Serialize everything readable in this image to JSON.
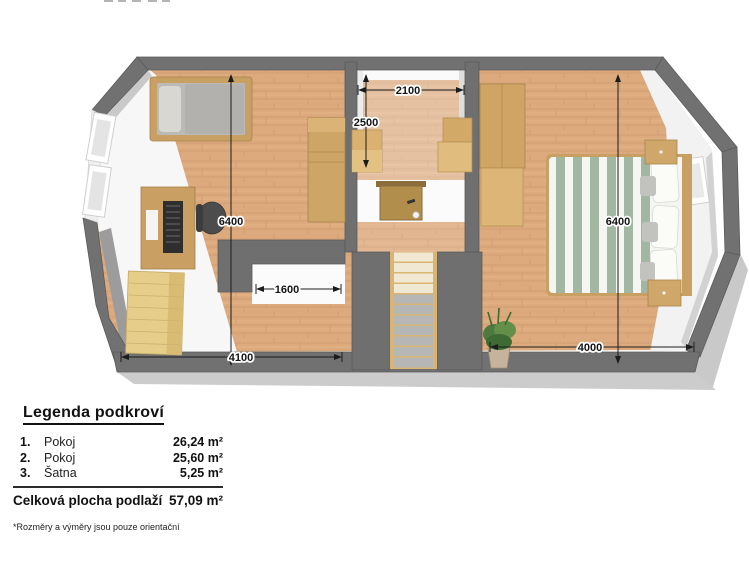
{
  "palette": {
    "wall_gray": "#717171",
    "wall_edge": "#5b5b5b",
    "wood_floor": "#dcaa7d",
    "wood_streak": "#c8956a",
    "low_ceiling_white": "#f7f7f7",
    "furniture_tan": "#cda266",
    "furniture_light_tan": "#e6cd8a",
    "mattress_gray": "#bbbab6",
    "duvet_green": "#a2b7a1",
    "chair_dark": "#4a4a4a",
    "plant_green": "#55813f",
    "dimension_text": "#141414"
  },
  "floorplan": {
    "dimensions": [
      {
        "id": "room1-height",
        "value": "6400"
      },
      {
        "id": "closet-width",
        "value": "2100"
      },
      {
        "id": "closet-depth",
        "value": "2500"
      },
      {
        "id": "stair-opening-width",
        "value": "1600"
      },
      {
        "id": "room1-width",
        "value": "4100"
      },
      {
        "id": "room2-width",
        "value": "4000"
      },
      {
        "id": "room2-height",
        "value": "6400"
      }
    ]
  },
  "legend": {
    "title": "Legenda podkroví",
    "rows": [
      {
        "num": "1.",
        "name": "Pokoj",
        "area": "26,24 m²"
      },
      {
        "num": "2.",
        "name": "Pokoj",
        "area": "25,60 m²"
      },
      {
        "num": "3.",
        "name": "Šatna",
        "area": "5,25 m²"
      }
    ],
    "total_label": "Celková plocha podlaží",
    "total_area": "57,09 m²",
    "footnote": "*Rozměry a výměry jsou pouze orientační"
  }
}
